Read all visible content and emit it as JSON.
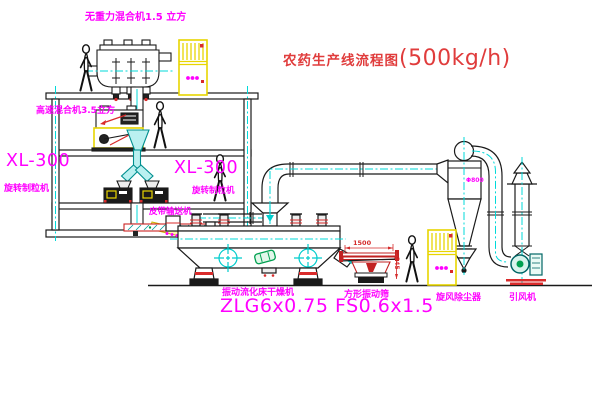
{
  "title": {
    "text": "农药生产线流程图",
    "capacity": "(500kg/h)"
  },
  "labels": {
    "weightless_mixer": "无重力混合机1.5 立方",
    "high_speed_mixer": "高速混合机3.5立方",
    "granulator_model_left": "XL-300",
    "granulator_left": "旋转制粒机",
    "granulator_model_right": "XL-300",
    "granulator_right": "旋转制粒机",
    "belt_conveyor": "皮带输送机",
    "dryer": "振动流化床干燥机",
    "dryer_model": "ZLG6x0.75",
    "screen": "方形振动筛",
    "screen_model": "FS0.6x1.5",
    "cyclone": "旋风除尘器",
    "induced_fan": "引风机"
  },
  "dimensions": {
    "screen_length": "1500",
    "screen_height": "345",
    "cyclone_diameter": "Φ800"
  },
  "colors": {
    "label_magenta": "#ff00ff",
    "title_red": "#e03c3c",
    "centerline_cyan": "#00d9d9",
    "line_black": "#1a1a1a",
    "cabinet_yellow": "#e8d500",
    "detail_red": "#d92b2b",
    "detail_green": "#00a050"
  }
}
